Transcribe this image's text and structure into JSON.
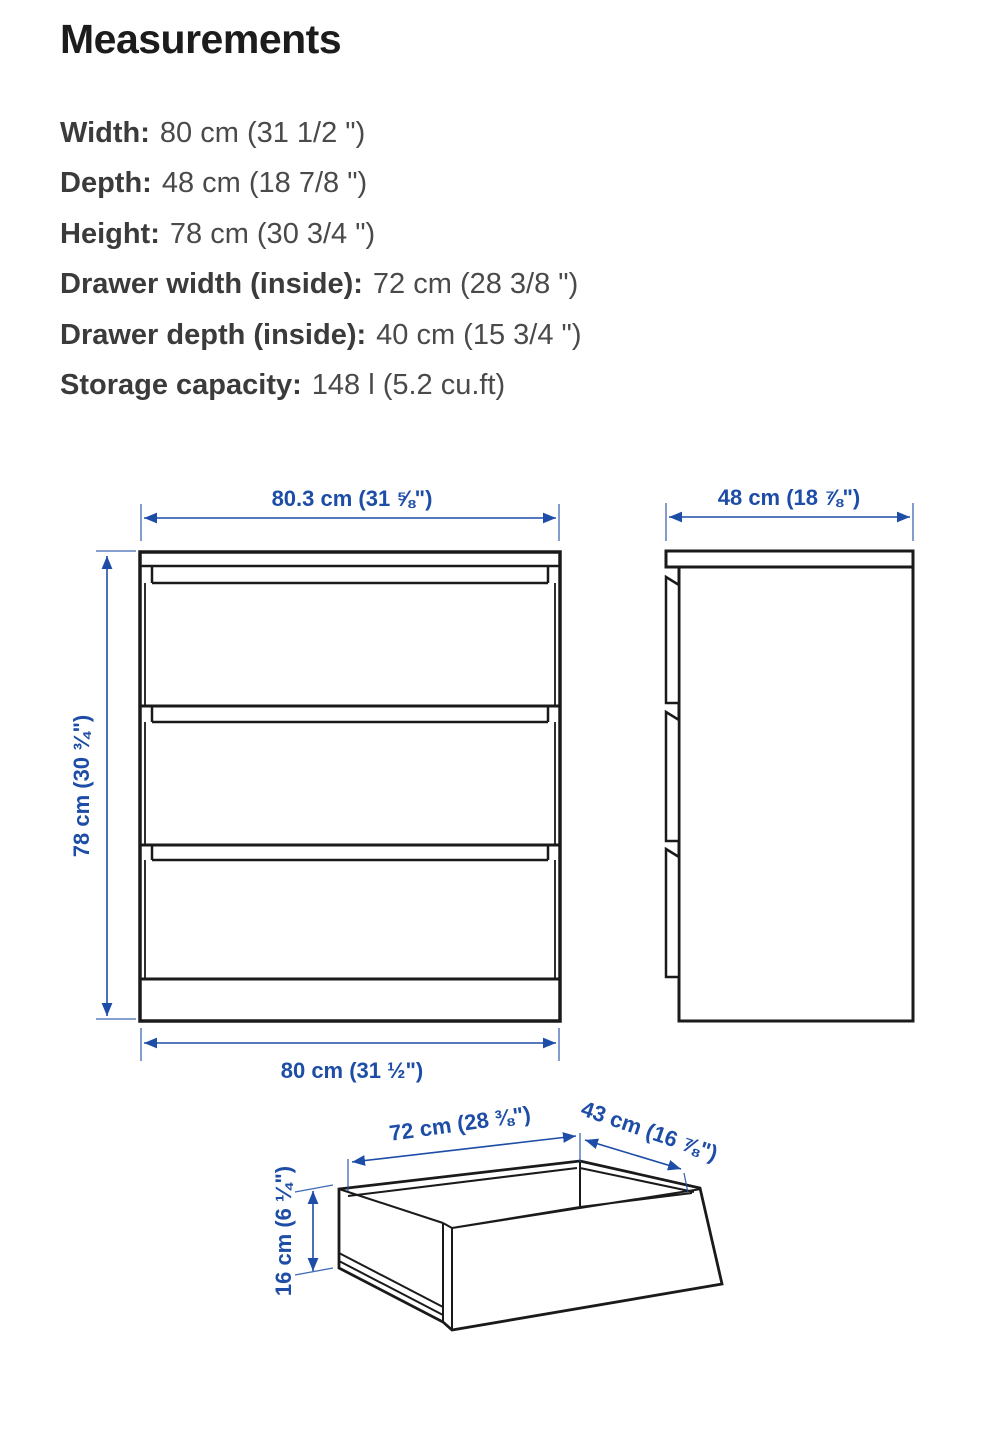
{
  "page": {
    "title": "Measurements"
  },
  "specs": [
    {
      "label": "Width:",
      "value": "80 cm (31 1/2 \")"
    },
    {
      "label": "Depth:",
      "value": "48 cm (18 7/8 \")"
    },
    {
      "label": "Height:",
      "value": "78 cm (30 3/4 \")"
    },
    {
      "label": "Drawer width (inside):",
      "value": "72 cm (28 3/8 \")"
    },
    {
      "label": "Drawer depth (inside):",
      "value": "40 cm (15 3/4 \")"
    },
    {
      "label": "Storage capacity:",
      "value": "148 l (5.2 cu.ft)"
    }
  ],
  "diagram": {
    "front_view": {
      "width_top": "80.3 cm (31 ⅝\")",
      "height_left": "78 cm (30 ¾\")",
      "width_bottom": "80 cm (31 ½\")"
    },
    "side_view": {
      "depth_top": "48 cm (18 ⅞\")"
    },
    "drawer_view": {
      "inner_width": "72 cm (28 ⅜\")",
      "outer_depth": "43 cm (16 ⅞\")",
      "height": "16 cm (6 ¼\")"
    }
  },
  "colors": {
    "dimension_blue": "#1d4da6",
    "line_black": "#1a1a1a",
    "background": "#ffffff"
  }
}
